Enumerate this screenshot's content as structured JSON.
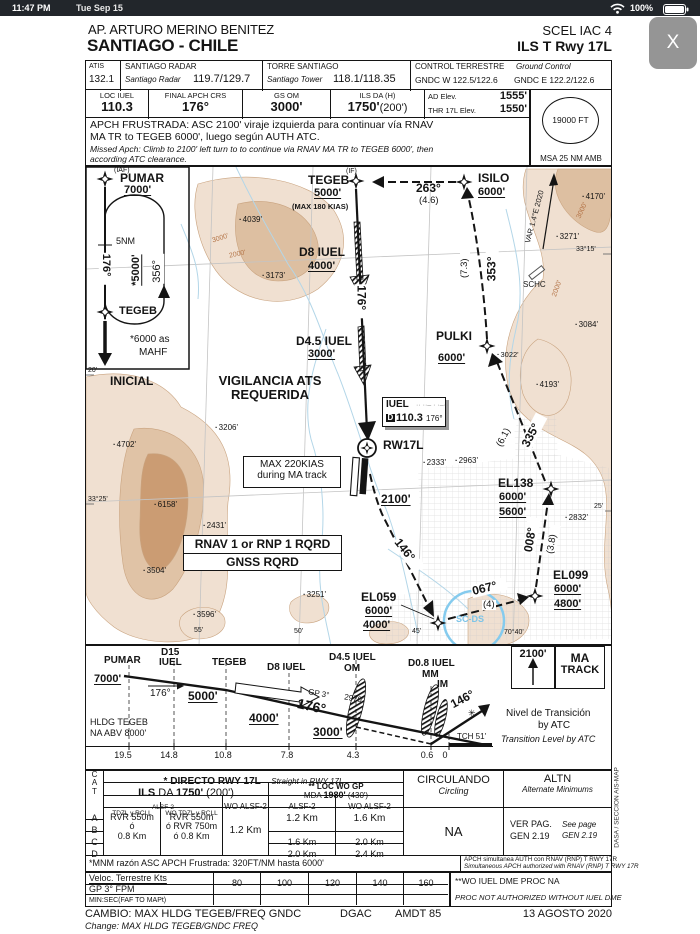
{
  "status_bar": {
    "time": "11:47 PM",
    "date": "Tue Sep 15",
    "battery_percent": "100%"
  },
  "close_button_label": "X",
  "header": {
    "airport": "AP. ARTURO MERINO BENITEZ",
    "city": "SANTIAGO - CHILE",
    "chart_code": "SCEL IAC 4",
    "procedure": "ILS T Rwy 17L"
  },
  "comms": {
    "atis_label": "ATIS",
    "atis_freq": "132.1",
    "radar_label": "SANTIAGO RADAR",
    "radar_name": "Santiago Radar",
    "radar_freq": "119.7/129.7",
    "tower_label": "TORRE SANTIAGO",
    "tower_name": "Santiago Tower",
    "tower_freq": "118.1/118.35",
    "ground_label": "CONTROL TERRESTRE",
    "ground_label_en": "Ground Control",
    "ground_freq_w": "GNDC W 122.5/122.6",
    "ground_freq_e": "GNDC E 122.2/122.6"
  },
  "proc": {
    "loc_label": "LOC IUEL",
    "loc_freq": "110.3",
    "crs_label": "FINAL APCH CRS",
    "crs": "176°",
    "gs_label": "GS OM",
    "gs_alt": "3000'",
    "da_label": "ILS DA (H)",
    "da_bold": "1750'",
    "da_paren": "(200')",
    "ad_elev_label": "AD Elev.",
    "ad_elev": "1555'",
    "thr_elev_label": "THR 17L Elev.",
    "thr_elev": "1550'",
    "msa_value": "19000 FT",
    "msa_label": "MSA 25 NM AMB"
  },
  "missed": {
    "line1": "APCH FRUSTRADA: ASC 2100' viraje izquierda para continuar vía RNAV",
    "line2": "MA TR to TEGEB 6000', luego según AUTH ATC.",
    "line3": "Missed Apch: Climb to 2100' left turn to to continue via RNAV MA TR to TEGEB 6000', then",
    "line4": "according ATC clearance."
  },
  "plan": {
    "hold": {
      "iaf": "(IAF)",
      "fix": "PUMAR",
      "alt": "7000'",
      "leg": "5NM",
      "inbound": "176°",
      "outbound": "356°",
      "hold_alt": "*5000'",
      "fix2": "TEGEB",
      "note1": "*6000 as",
      "note2": "MAHF",
      "segment": "INICIAL"
    },
    "if_tag": "(IF)",
    "tegeb": "TEGEB",
    "tegeb_alt": "5000'",
    "tegeb_speed": "(MAX 180 KIAS)",
    "isilo": "ISILO",
    "isilo_alt": "6000'",
    "crs_isilo_tegeb": "263°",
    "dist_isilo_tegeb": "(4.6)",
    "crs_pulki_isilo": "353°",
    "dist_pulki_isilo": "(7.3)",
    "var_label": "VAR 1.4°E 2020",
    "d8": "D8 IUEL",
    "d8_alt": "4000'",
    "fac_crs": "176°",
    "d45": "D4.5 IUEL",
    "d45_alt": "3000'",
    "pulki": "PULKI",
    "pulki_alt": "6000'",
    "crs_el138_pulki": "335°",
    "dist_el138_pulki": "(6.1)",
    "vigilancia1": "VIGILANCIA ATS",
    "vigilancia2": "REQUERIDA",
    "iuel": {
      "name": "IUEL",
      "morse": "·· ··– · ·–··",
      "dme": "D",
      "freq": "110.3",
      "crs": "176°"
    },
    "rw17l": "RW17L",
    "ma_speed1": "MAX 220KIAS",
    "ma_speed2": "during MA track",
    "ma_alt": "2100'",
    "crs_rw_el059": "146°",
    "el059": "EL059",
    "el059_alt1": "6000'",
    "el059_alt2": "4000'",
    "crs_el059_el099": "067°",
    "dist_el059_el099": "(4)",
    "el099": "EL099",
    "el099_alt1": "6000'",
    "el099_alt2": "4800'",
    "crs_el099_el138": "008°",
    "dist_el099_el138": "(3.8)",
    "el138": "EL138",
    "el138_alt1": "6000'",
    "el138_alt2": "5600'",
    "rnav1": "RNAV 1 or RNP 1 RQRD",
    "rnav2": "GNSS RQRD",
    "schc": "SCHC",
    "scds": "SC-DS",
    "spots": {
      "s4039": "4039'",
      "s3173": "3173'",
      "s4170": "4170'",
      "s3271": "3271'",
      "s3084": "3084'",
      "s3022": "3022'",
      "s4193": "4193'",
      "s2832": "2832'",
      "s2333": "2333'",
      "s2963": "2963'",
      "s4702": "4702'",
      "s3206": "3206'",
      "s6158": "6158'",
      "s2431": "2431'",
      "s3504": "3504'",
      "s3596": "3596'",
      "s3251": "3251'"
    },
    "contours": {
      "c1": "3000'",
      "c2": "2000'",
      "c3": "3000'",
      "c4": "2000'"
    },
    "coords": {
      "lat1": "33°15'",
      "lat2": "33°25'",
      "t20": "20'",
      "t25": "25'",
      "lon55": "55'",
      "lon50": "50'",
      "lon45": "45'",
      "lon40": "70°40'"
    }
  },
  "profile": {
    "pumar": "PUMAR",
    "pumar_alt": "7000'",
    "d15a": "D15",
    "d15b": "IUEL",
    "tegeb": "TEGEB",
    "tegeb_alt": "5000'",
    "crs_small": "176°",
    "d8": "D8 IUEL",
    "d8_alt": "4000'",
    "gp": "GP 3°",
    "gp_check": "2970'",
    "crs_big": "176°",
    "d45a": "D4.5 IUEL",
    "d45b": "OM",
    "d45_alt": "3000'",
    "d08a": "D0.8 IUEL",
    "d08b": "MM",
    "d08c": "IM",
    "ma_crs": "146°",
    "tch": "TCH 51'",
    "mapt_symbol": "✳",
    "hldg1": "HLDG TEGEB",
    "hldg2": "NA ABV 8000'",
    "trans1": "Nivel de Transición",
    "trans2": "by ATC",
    "trans3": "Transition Level by ATC",
    "ma_alt": "2100'",
    "ma_box1": "MA",
    "ma_box2": "TRACK",
    "dist": [
      "19.5",
      "14.8",
      "10.8",
      "7.8",
      "4.3",
      "0.6",
      "0"
    ]
  },
  "minimums": {
    "cat": [
      "C",
      "A",
      "T"
    ],
    "rows": [
      "A",
      "B",
      "C",
      "D"
    ],
    "directo": "* DIRECTO  RWY 17L",
    "directo_en": "Straight in RWY 17L",
    "ils1": "ILS",
    "ils2": "DA",
    "ils3": "1750'",
    "ils4": "(200')",
    "loc1": "** LOC WO GP",
    "loc2a": "MDA",
    "loc2b": "1980'",
    "loc2c": "(430')",
    "alsf": "ALSF-2",
    "tdzl": "TDZL y RCLL",
    "wo_tdzl": "WO TDZL y RCLL",
    "wo_alsf": "WO ALSF-2",
    "loc_alsf": "ALSF-2",
    "loc_wo_alsf": "WO ALSF-2",
    "ils_tdzl": [
      "RVR 550m",
      "ó",
      "0.8 Km"
    ],
    "ils_wotdzl": [
      "RVR 550m",
      "ó  RVR 750m",
      "ó  0.8 Km"
    ],
    "ils_woalsf": "1.2 Km",
    "loc_alsf_ab": "1.2 Km",
    "loc_alsf_c": "1.6 Km",
    "loc_alsf_d": "2.0 Km",
    "loc_woalsf_ab": "1.6 Km",
    "loc_woalsf_c": "2.0 Km",
    "loc_woalsf_d": "2.4 Km",
    "circ": "CIRCULANDO",
    "circ_en": "Circling",
    "circ_val": "NA",
    "altn": "ALTN",
    "altn_en": "Alternate Minimums",
    "altn_v1": "VER PAG.",
    "altn_v2": "GEN 2.19",
    "altn_v3": "See page",
    "altn_v4": "GEN 2.19",
    "note_left": "*MNM razón ASC APCH Frustrada: 320FT/NM hasta 6000'",
    "note_right1": "APCH simultanea AUTH con RNAV (RNP) T RWY 17R",
    "note_right2": "Simultaneous APCH authorized with RNAV (RNP) T RWY 17R"
  },
  "speed": {
    "label1": "Veloc. Terrestre Kts",
    "speeds": [
      "80",
      "100",
      "120",
      "140",
      "160"
    ],
    "label2": "GP  3° FPM",
    "label3": "MIN:SEC(FAF TO MAPt)",
    "note1": "**WO IUEL DME PROC NA",
    "note2": "PROC NOT AUTHORIZED WITHOUT IUEL DME"
  },
  "footer": {
    "cambio": "CAMBIO: MAX HLDG TEGEB/FREQ GNDC",
    "agency": "DGAC",
    "amdt": "AMDT 85",
    "date": "13 AGOSTO 2020",
    "change": "Change:  MAX HLDG TEGEB/GNDC FREQ"
  },
  "margin": {
    "side_text": "DASA / SECCION AIS-MAP"
  }
}
